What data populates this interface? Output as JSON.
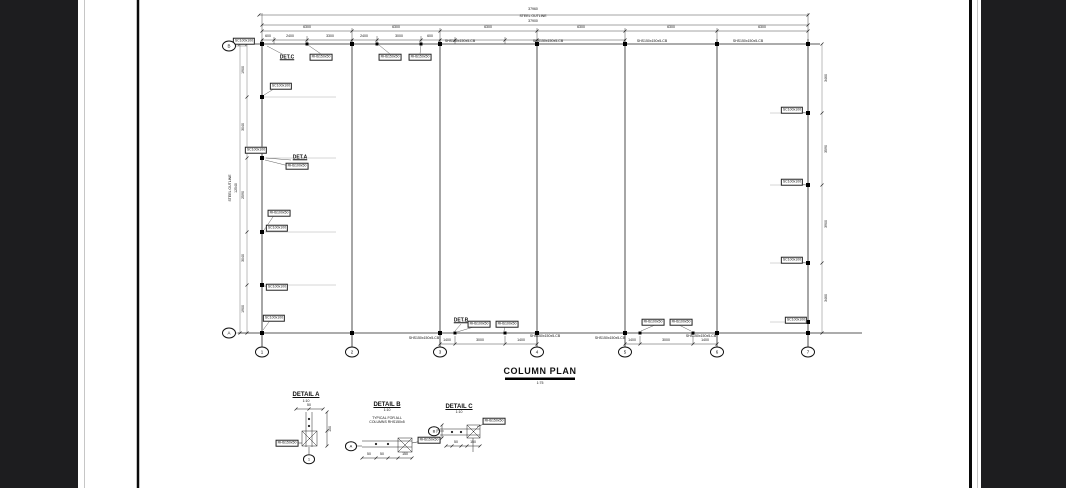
{
  "plan": {
    "title": "COLUMN PLAN",
    "scale": "1:75",
    "grid_rows": [
      "B",
      "A"
    ],
    "grid_cols": [
      "1",
      "2",
      "3",
      "4",
      "5",
      "6",
      "7"
    ],
    "callouts": {
      "a": "DET.A",
      "b": "DET.B",
      "c": "DET.C"
    },
    "member_labels": {
      "shs": "SHS150x150x5-CB",
      "rhs150": "RHS150x50",
      "rhs100": "RHS100x50",
      "sc": "SC100x100"
    },
    "dims": {
      "overall_top": "37960",
      "steel_outline": "STEEL OUTLINE",
      "overall_top2": "37900",
      "bay": "6300",
      "top_subs": [
        "600",
        "2400",
        "3300",
        "2400",
        "3000",
        "600"
      ],
      "bottom_subs": [
        "1400",
        "3000",
        "1400"
      ],
      "left_chain": [
        "1900",
        "3040",
        "2590",
        "3040",
        "1900"
      ],
      "left_overall": "12540",
      "left_outline": "STEEL OUTLINE",
      "right_chain": [
        "3460",
        "3590",
        "3900",
        "3460"
      ]
    }
  },
  "details": {
    "a": {
      "title": "DETAIL A",
      "scale": "1:10",
      "label": "RHS150x50",
      "bubble": "1",
      "dim1": "50",
      "dim2": "150"
    },
    "b": {
      "title": "DETAIL B",
      "scale": "1:10",
      "note1": "TYPICAL FOR ALL",
      "note2": "COLUMNS RHS150x5",
      "label": "RHS150x50",
      "bubble": "A",
      "dim1": "50",
      "dim2": "50",
      "dim3": "150"
    },
    "c": {
      "title": "DETAIL C",
      "scale": "1:10",
      "label": "RHS150x50",
      "bubble": "B",
      "dim1": "50",
      "dim2": "150",
      "dim3": "75"
    }
  }
}
